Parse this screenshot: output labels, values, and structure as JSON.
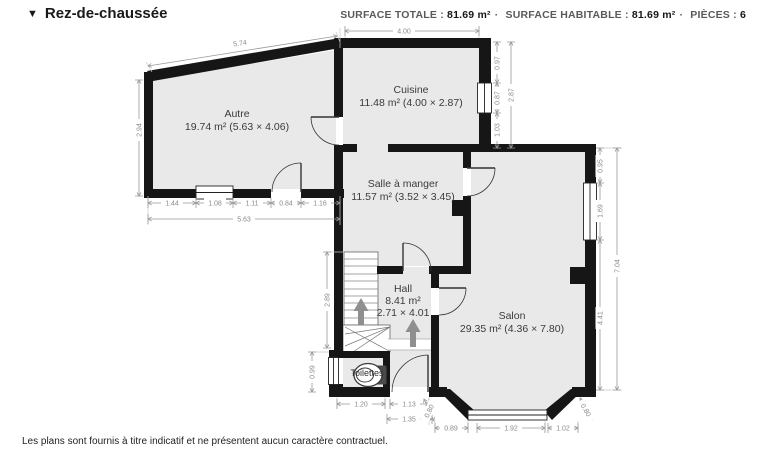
{
  "header": {
    "collapse_glyph": "▼",
    "title": "Rez-de-chaussée",
    "surface_totale_label": "SURFACE TOTALE :",
    "surface_totale_value": "81.69 m²",
    "dot1": "·",
    "surface_habitable_label": "SURFACE HABITABLE :",
    "surface_habitable_value": "81.69 m²",
    "dot2": "·",
    "pieces_label": "PIÈCES :",
    "pieces_value": "6"
  },
  "rooms": {
    "autre": {
      "name": "Autre",
      "info": "19.74 m² (5.63 × 4.06)"
    },
    "cuisine": {
      "name": "Cuisine",
      "info": "11.48 m² (4.00 × 2.87)"
    },
    "sam": {
      "name": "Salle à manger",
      "info": "11.57 m² (3.52 × 3.45)"
    },
    "hall": {
      "name": "Hall",
      "info": "8.41 m²",
      "info2": "2.71 × 4.01"
    },
    "salon": {
      "name": "Salon",
      "info": "29.35 m² (4.36 × 7.80)"
    },
    "toilettes": {
      "name": "Toilettes"
    }
  },
  "dims": {
    "slope": "5.74",
    "cuisine_top": "4.00",
    "autre_left": "2.94",
    "ab1": "1.44",
    "ab2": "1.08",
    "ab3": "1.11",
    "ab4": "0.84",
    "ab5": "1.16",
    "ab_total": "5.63",
    "cr1": "0.97",
    "cr2": "0.87",
    "cr3": "1.03",
    "cr_total": "2.87",
    "sr1": "0.95",
    "sr2": "1.69",
    "sr3": "4.41",
    "sr_total": "7.04",
    "stairs": "2.89",
    "wc": "0.99",
    "b1": "1.20",
    "b2": "1.13",
    "b3": "1.35",
    "bay1": "0.89",
    "bay2": "1.92",
    "bay3": "1.02",
    "bayangle_l": "0.80",
    "bayangle_r": "0.80"
  },
  "footer": {
    "text": "Les plans sont fournis à titre indicatif et ne présentent aucun caractère contractuel."
  }
}
